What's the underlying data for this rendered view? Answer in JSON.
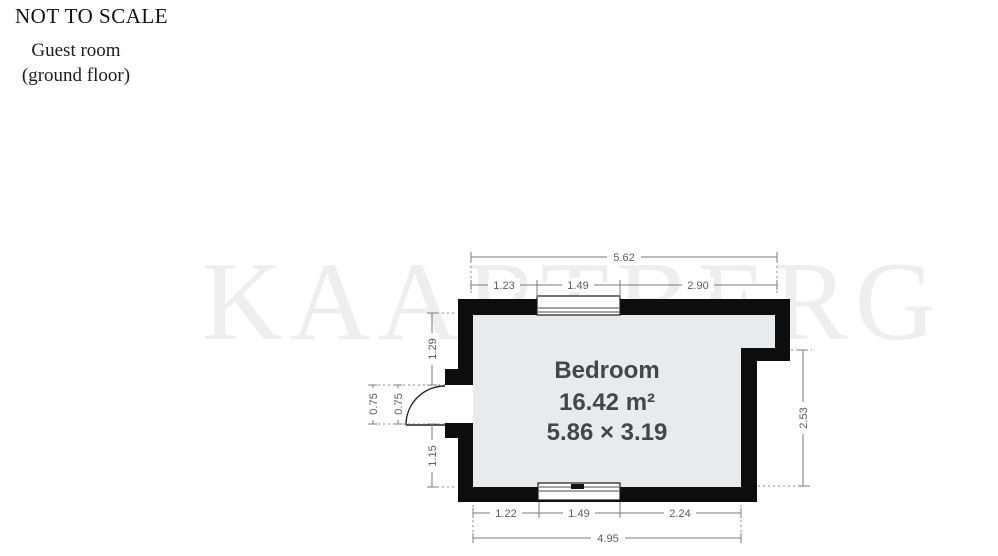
{
  "header": {
    "scale_note": "NOT TO SCALE",
    "room_title_line1": "Guest room",
    "room_title_line2": "(ground floor)"
  },
  "watermark": "KAARTBERG",
  "room": {
    "name": "Bedroom",
    "area": "16.42 m²",
    "size": "5.86 × 3.19"
  },
  "dims": {
    "top_total": "5.62",
    "top_seg1": "1.23",
    "top_seg2": "1.49",
    "top_seg3": "2.90",
    "left_upper": "1.29",
    "door_width_outer": "0.75",
    "door_width_inner": "0.75",
    "left_lower": "1.15",
    "right_side": "2.53",
    "bottom_seg1": "1.22",
    "bottom_seg2": "1.49",
    "bottom_seg3": "2.24",
    "bottom_total": "4.95"
  },
  "colors": {
    "wall": "#0d0d0d",
    "room_fill": "#e9eaeb",
    "dim_line": "#7b7b7b",
    "dim_text": "#5d5d5d",
    "room_text": "#42474c"
  }
}
